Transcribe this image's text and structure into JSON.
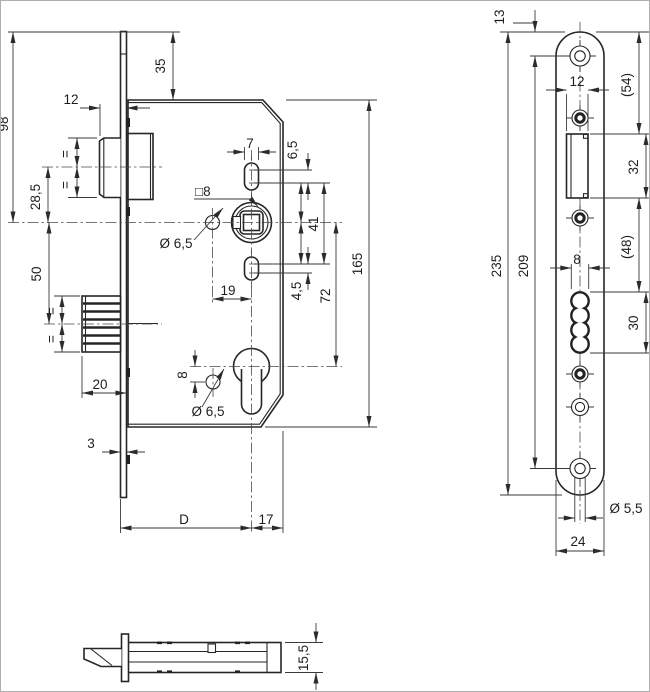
{
  "meta": {
    "title": "Mortise lock technical drawing"
  },
  "dims": {
    "left": {
      "plate_top_to_body": "35",
      "latch_protrusion": "12",
      "top_to_spindle": "98",
      "latch_to_spindle": "28,5",
      "spindle_to_deadbolt": "50",
      "deadbolt_throw": "20",
      "plate_thickness": "3",
      "slot_width": "7",
      "slot_top_cc": "6,5",
      "square_spindle": "□8",
      "hole_dia": "Ø 6,5",
      "hub_span": "41",
      "hole_offset": "19",
      "slot_bottom_cc": "4,5",
      "spindle_to_cylinder": "72",
      "case_height": "165",
      "cyl_hole_offset": "8",
      "backset": "D",
      "center_to_back": "17",
      "equal": "="
    },
    "right": {
      "top_to_screw": "13",
      "top_to_latch": "(54)",
      "latch_width": "12",
      "latch_height": "32",
      "plate_length": "235",
      "screw_cc": "209",
      "latch_to_slot": "(48)",
      "slot_width": "8",
      "slot_height": "30",
      "screw_dia": "Ø 5,5",
      "plate_width": "24"
    },
    "bottom": {
      "case_depth": "15,5"
    }
  }
}
